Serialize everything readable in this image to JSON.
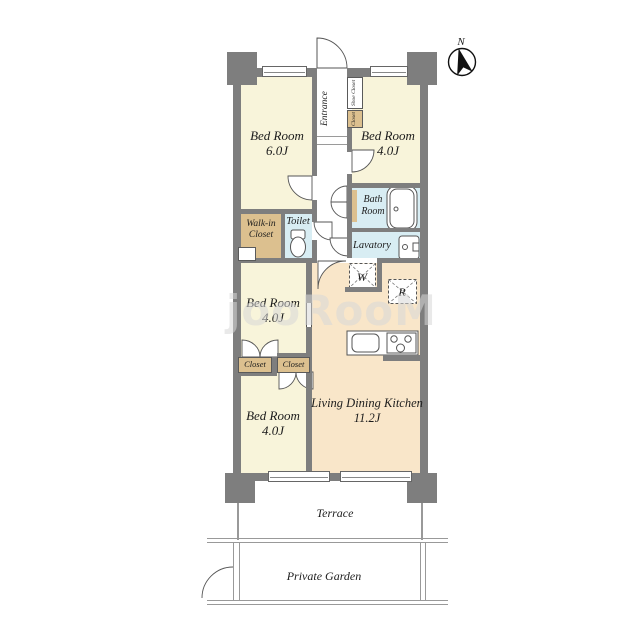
{
  "title": "apartment-floor-plan",
  "compass": {
    "label": "N"
  },
  "watermark": {
    "text": "jooRooM"
  },
  "rooms": {
    "bed6": {
      "name": "Bed Room",
      "size": "6.0J"
    },
    "bed4_top": {
      "name": "Bed Room",
      "size": "4.0J"
    },
    "bed4_mid": {
      "name": "Bed Room",
      "size": "4.0J"
    },
    "bed4_bottom": {
      "name": "Bed Room",
      "size": "4.0J"
    },
    "ldk": {
      "name": "Living Dining Kitchen",
      "size": "11.2J"
    },
    "bath": {
      "line1": "Bath",
      "line2": "Room"
    },
    "lavatory": {
      "name": "Lavatory"
    },
    "toilet": {
      "name": "Toilet"
    },
    "walk_in_closet": {
      "line1": "Walk-in",
      "line2": "Closet"
    },
    "entrance": {
      "name": "Entrance"
    },
    "shoe_closet": {
      "name": "Shoe Closet"
    },
    "entry_closet": {
      "name": "Closet"
    },
    "closet_left": {
      "name": "Closet"
    },
    "closet_right": {
      "name": "Closet"
    },
    "terrace": {
      "name": "Terrace"
    },
    "private_garden": {
      "name": "Private Garden"
    }
  },
  "appliances": {
    "washer": "W",
    "refrigerator": "R"
  },
  "colors": {
    "wall": "#7e7e7e",
    "room_cream": "#f8f4da",
    "ldk_peach": "#f9e6c9",
    "wet_area_blue": "#d8edf3",
    "closet_tan": "#dcc08f",
    "linework": "#555555"
  }
}
